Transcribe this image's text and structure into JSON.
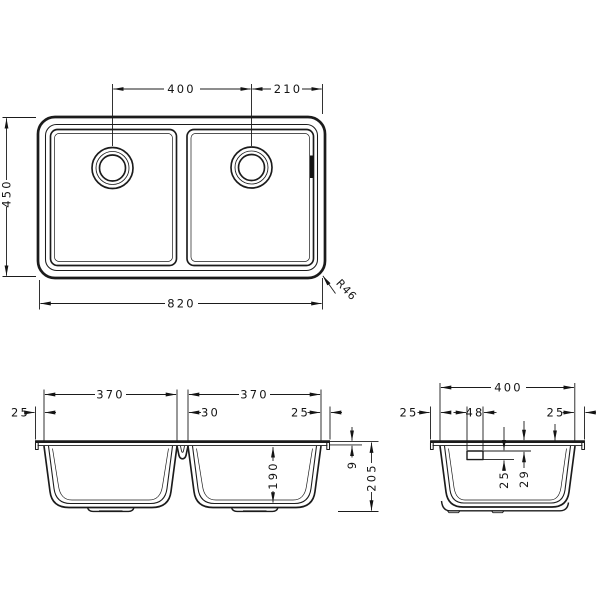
{
  "top_view": {
    "drain_spacing": "400",
    "drain_to_edge": "210",
    "overall_depth": "450",
    "overall_width": "820",
    "corner_radius": "R46"
  },
  "front_view": {
    "bowl1_width": "370",
    "bowl2_width": "370",
    "left_rim": "25",
    "center_web": "30",
    "right_rim": "25",
    "bowl_depth": "190",
    "rim_thickness": "9",
    "overall_height": "205"
  },
  "side_view": {
    "bowl_width": "400",
    "left_rim": "25",
    "drain_width": "48",
    "right_rim": "25",
    "drain_height": "25",
    "rim_to_drain": "29"
  }
}
